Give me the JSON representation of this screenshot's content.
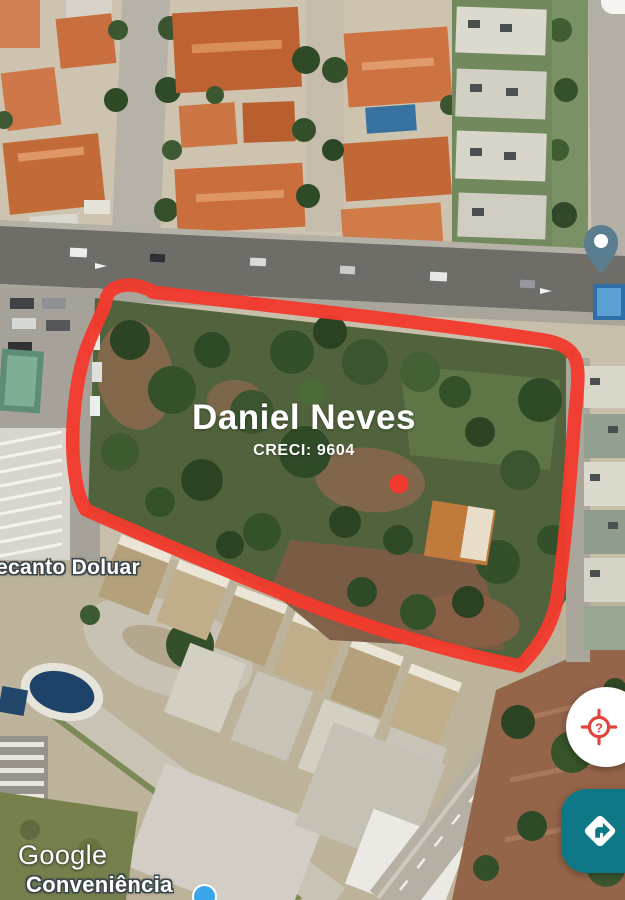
{
  "annotation": {
    "title": "Daniel Neves",
    "subtitle": "CRECI: 9604",
    "outline_color": "#f23a2e",
    "dot_color": "#f23a2e"
  },
  "map_labels": {
    "neighborhood": "ecanto Doluar",
    "poi_name": "Conveniência",
    "watermark": "Google"
  },
  "markers": {
    "pin": {
      "icon": "map-pin-icon",
      "color": "#5b7d90"
    },
    "poi_dot": {
      "icon": "poi-dot-icon",
      "color": "#3ba5ea"
    }
  },
  "buttons": {
    "location_help": {
      "icon": "location-question-icon",
      "bg": "#ffffff",
      "icon_color": "#e2443a"
    },
    "directions": {
      "icon": "directions-icon",
      "bg": "#0e7886",
      "icon_color": "#ffffff"
    }
  }
}
